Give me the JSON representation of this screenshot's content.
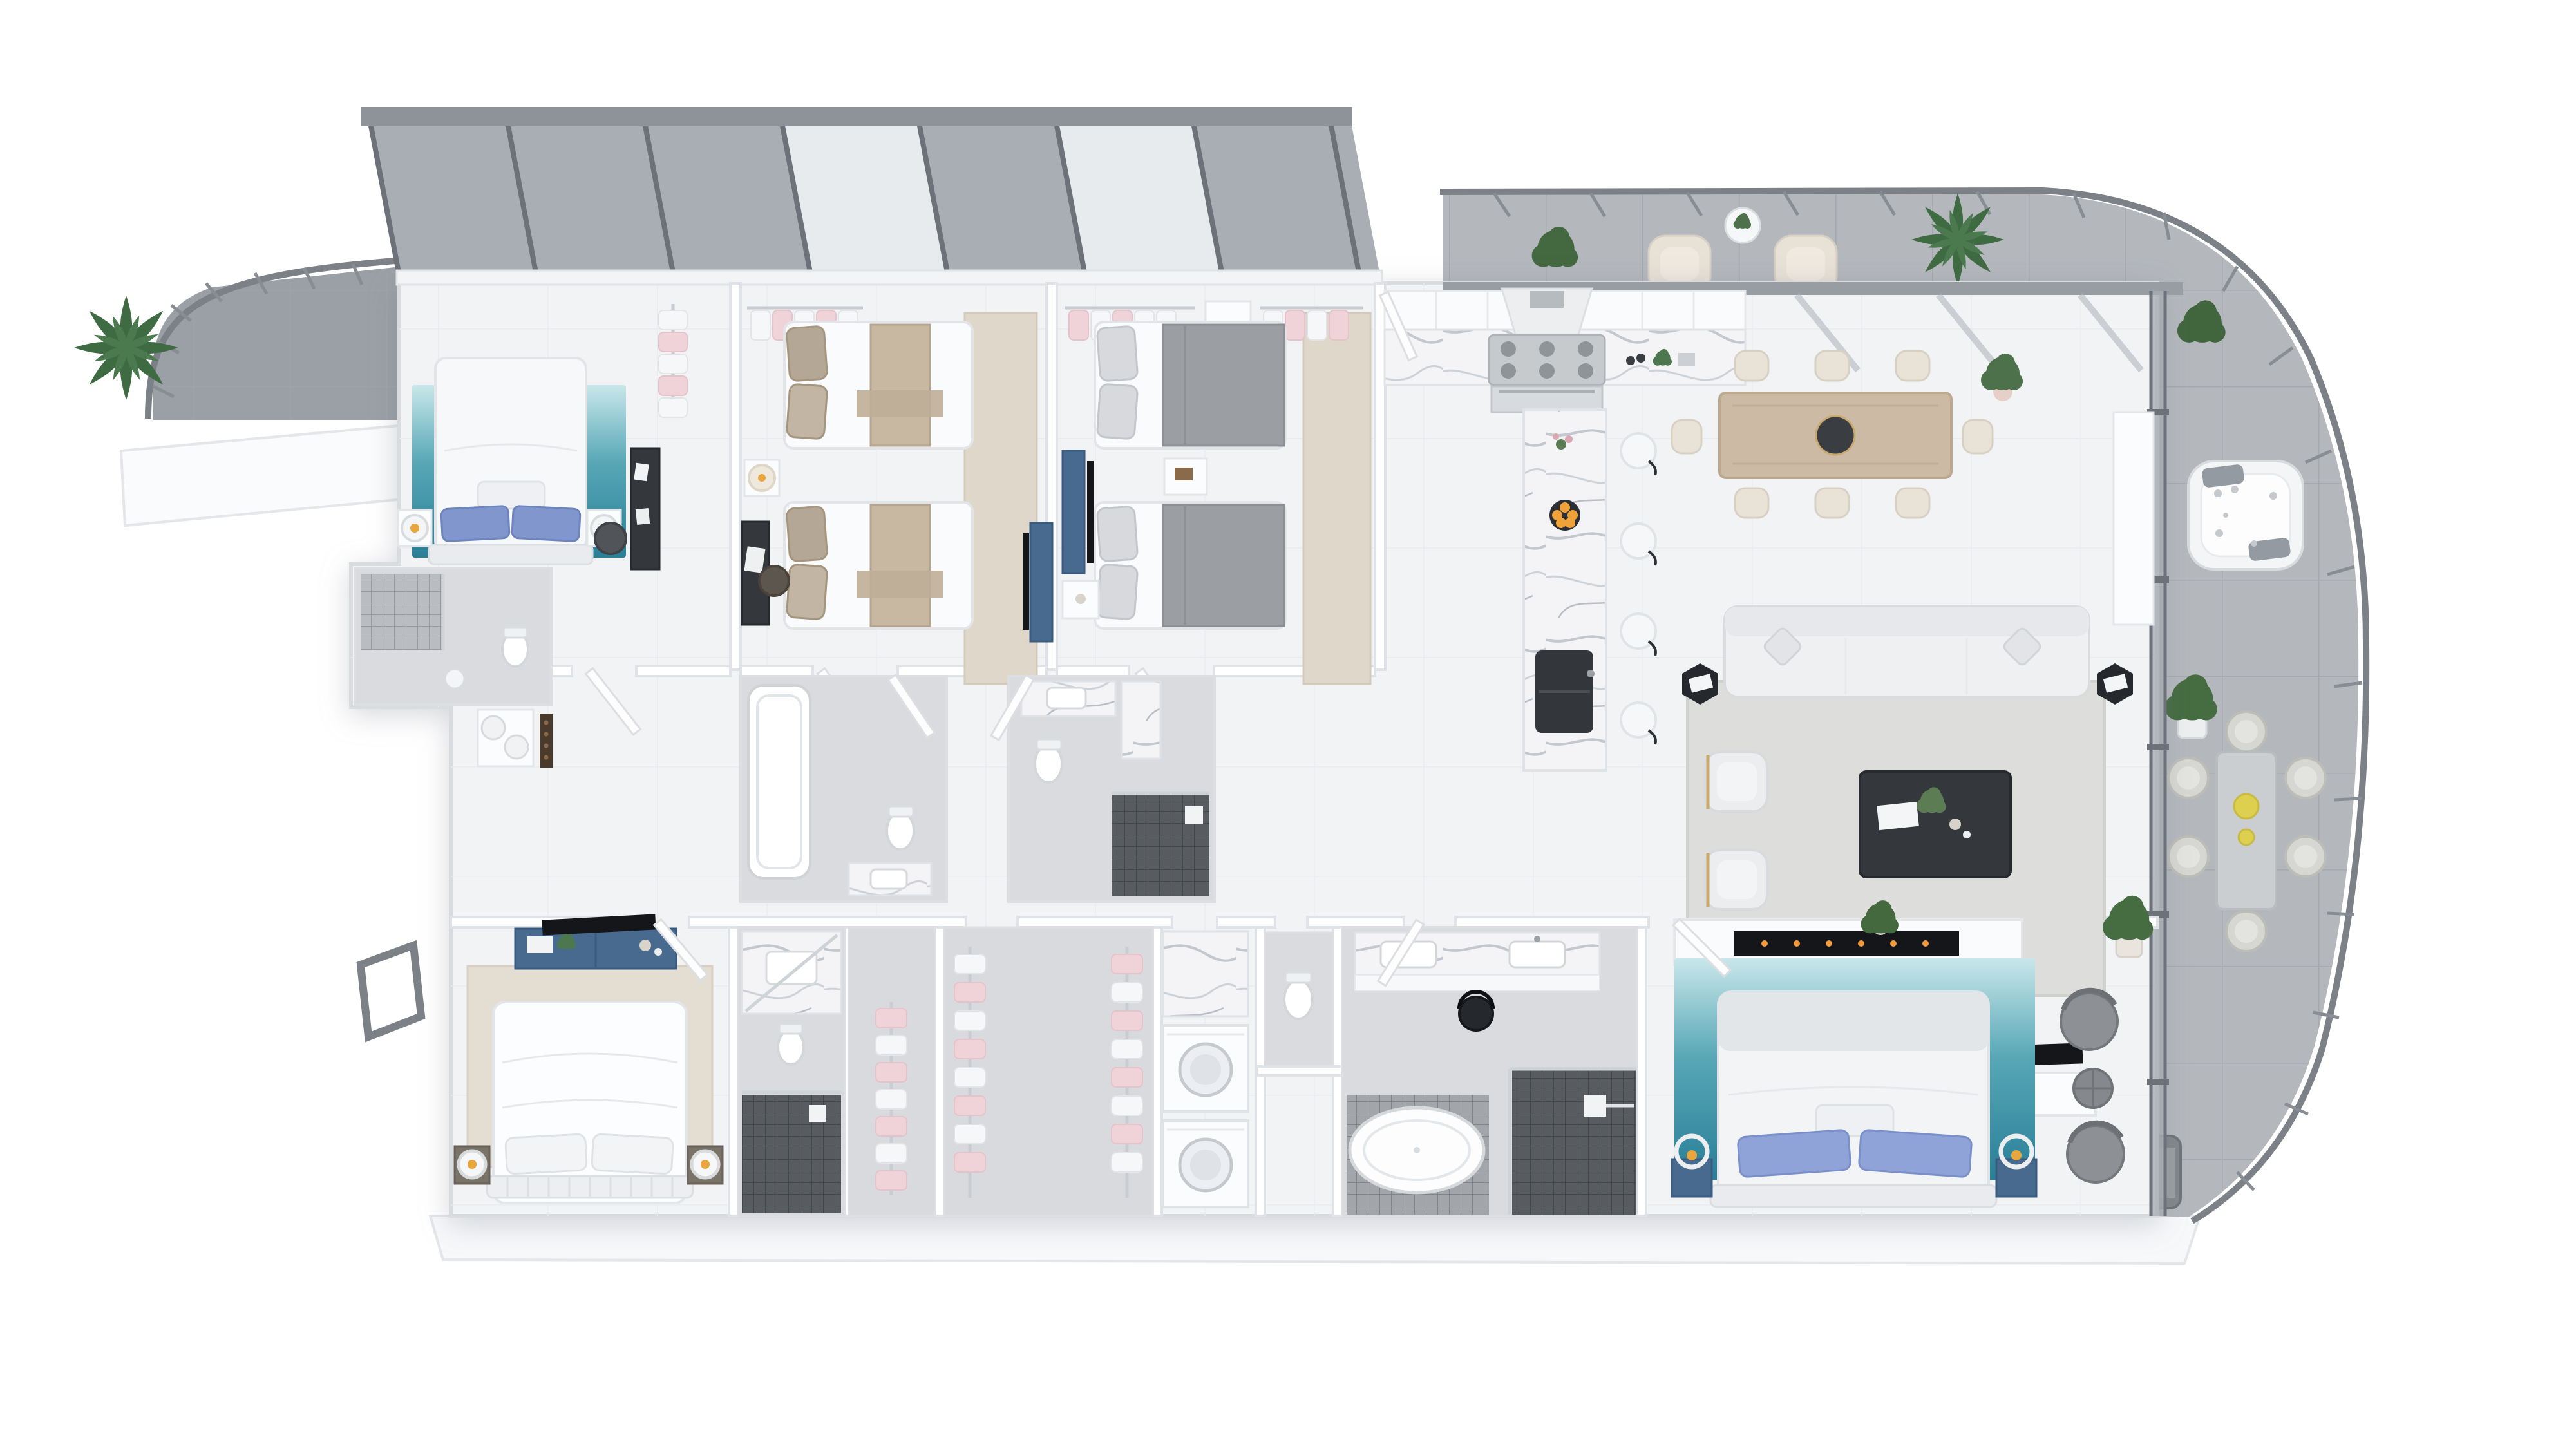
{
  "scene": {
    "type": "3d-floorplan-top-view-render",
    "style": "white architectural dollhouse render, no text labels",
    "background": "#ffffff"
  },
  "palette": {
    "floor": "#f2f3f5",
    "wetFloor": "#d9dbde",
    "closetFloor": "#d8dade",
    "wall": "#ffffff",
    "wallEdge": "#dfe2e6",
    "balcony": "#b4b8bd",
    "terrace": "#9aa0a6",
    "plinth": "#f7f8fa",
    "railing": "#7c8187",
    "glass": "#a9aeb4",
    "glassBright": "#eef0f2",
    "glassFrame": "#6d727a",
    "glassCap": "#8e939a",
    "pergola": "#989da3",
    "rafter": "#b2b6bb",
    "marbleBase": "#f4f4f6",
    "marbleVein": "#c3c8cf",
    "tealRugLight": "#c9e7ea",
    "tealRugDeep": "#2a7f97",
    "beigeRug": "#ded7ca",
    "livingRug": "#dddddb",
    "masterRug": "#e3ddd2",
    "wood": "#ccbaa5",
    "creamChair": "#e9e3d7",
    "navy": "#476a8e",
    "navyEdge": "#3a5a7e",
    "tvBlack": "#141619",
    "darkTable": "#34383c",
    "sideTableBlack": "#25282c",
    "stainless": "#c6cacd",
    "burner": "#8f9499",
    "sinkBlack": "#33373b",
    "tanBlanket": "#c8b7a1",
    "taupePillow": "#b5a795",
    "grayBlanket": "#9b9fa4",
    "lightPillow": "#d7d9dc",
    "periwinklePillow": "#8fa3d8",
    "bluePillow": "#8096cc",
    "mosaicDark": "#585c61",
    "mosaicLight": "#a2a6ab",
    "plantGreen": "#4c714b",
    "plantDark": "#3a5f3e",
    "orangeFruit": "#f0a23a",
    "yellowPlate": "#ddd04e",
    "lampAmber": "#e8a63c",
    "goldFrame": "#c8a96f",
    "pinkClothes": "#efd3d8",
    "whiteClothes": "#f6f7f8",
    "pinkPot": "#e6cfc8",
    "grayChair": "#8d9094",
    "bbq": "#83878c",
    "sofa": "#eef0f2"
  },
  "inventory": {
    "bedrooms": 5,
    "beds_total": 6,
    "single_beds": 4,
    "double_beds": 3,
    "bar_stools": 4,
    "dining_chairs_indoor": 8,
    "dining_chairs_outdoor": 6,
    "balcony_armchairs": 2,
    "sun_loungers": 2,
    "jacuzzi": 1,
    "bbq_grill": 1,
    "freestanding_tub": 1,
    "washer_dryer_units": 2,
    "fireplace": 1,
    "plants": 10
  }
}
